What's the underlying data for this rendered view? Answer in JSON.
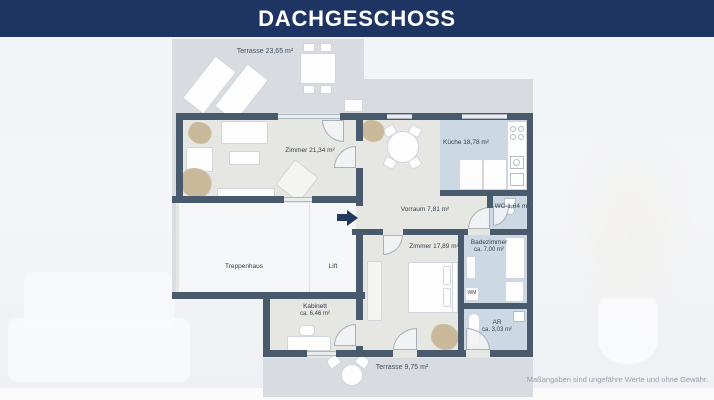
{
  "header": {
    "title": "DACHGESCHOSS"
  },
  "plan": {
    "labels": {
      "terrasse_top": "Terrasse 23,65 m²",
      "zimmer_living": "Zimmer 21,34 m²",
      "kueche": "Küche 18,78 m²",
      "vorraum": "Vorraum 7,81 m²",
      "wc": "WC 1,64 m²",
      "zimmer_bed": "Zimmer 17,89 m²",
      "badezimmer_name": "Badezimmer",
      "badezimmer_area": "ca. 7,00 m²",
      "treppenhaus": "Treppenhaus",
      "lift": "Lift",
      "kabinett_name": "Kabinett",
      "kabinett_area": "ca. 6,46 m²",
      "ar_name": "AR",
      "ar_area": "ca. 3,03 m²",
      "wm": "WM",
      "terrasse_bottom": "Terrasse 9,75 m²"
    },
    "colors": {
      "header_navy": "#1e3564",
      "wall": "#4a5a6d",
      "floor": "#e6e6e2",
      "wet_floor": "#ccd9e4",
      "plan_background": "#d8dbdf",
      "stairwell": "#f4f6f8"
    }
  },
  "footer": {
    "disclaimer": "Maßangaben sind ungefähre Werte und ohne Gewähr."
  }
}
